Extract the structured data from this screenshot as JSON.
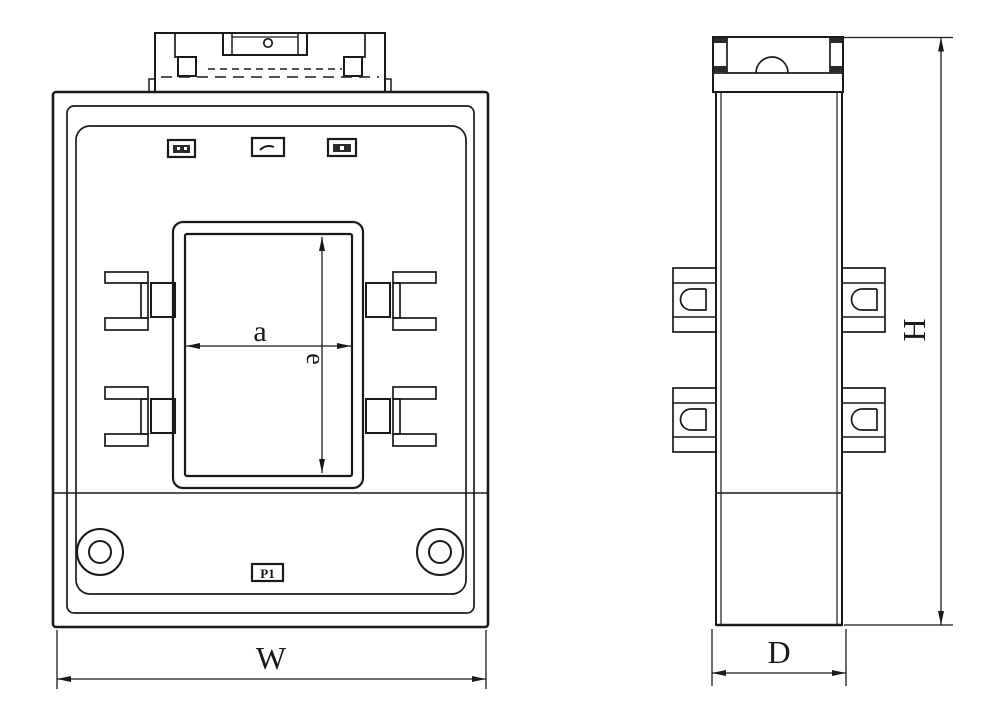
{
  "drawing": {
    "dim_labels": {
      "window_width": "a",
      "window_height": "e",
      "overall_width": "W",
      "overall_height": "H",
      "overall_depth": "D"
    },
    "terminal_label": "P1",
    "colors": {
      "line": "#1a1a1a",
      "background": "#ffffff"
    }
  }
}
